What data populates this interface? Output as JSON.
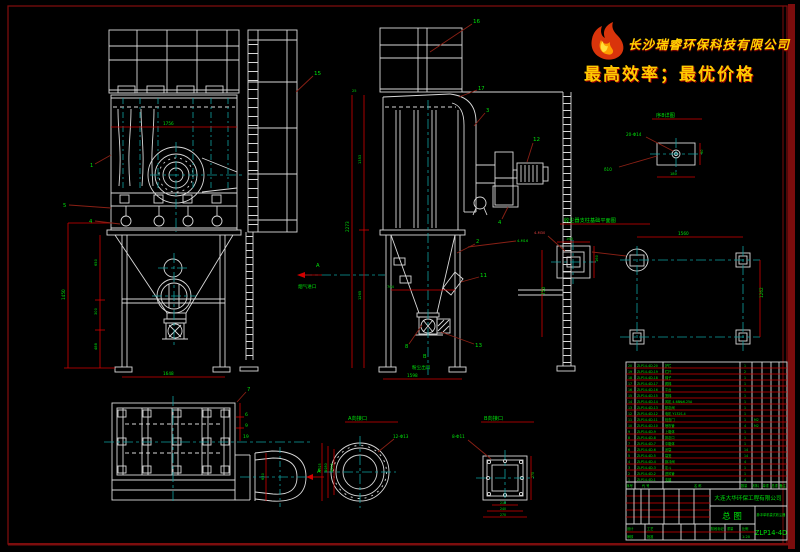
{
  "logo": {
    "company": "长沙瑞睿环保科技有限公司",
    "tagline": "最高效率；最优价格"
  },
  "front": {
    "balloons": {
      "b15": "15",
      "b1": "1",
      "b5": "5",
      "b4": "4"
    },
    "dims": {
      "mid_width": "1756",
      "total_h": "1450",
      "seg1": "650",
      "seg2": "300",
      "seg3": "488",
      "bottom": "1648"
    }
  },
  "side": {
    "balloons": {
      "b16": "16",
      "b17": "17",
      "b3": "3",
      "b12": "12",
      "b4": "4",
      "b2": "2",
      "b11": "11",
      "b13": "13",
      "b8": "8"
    },
    "labels": {
      "arrow_a": "A",
      "inlet": "烟气进口",
      "arrow_b": "B",
      "outlet": "粉尘出口",
      "bolt_note": "4-M16"
    },
    "dims": {
      "total": "2273",
      "upper": "1353",
      "lower": "1265",
      "right": "750",
      "hopper": "704",
      "bottom": "1598",
      "top": "25"
    }
  },
  "plan": {
    "balloons": {
      "b7": "7",
      "b6": "6",
      "b9": "9",
      "b19": "19"
    },
    "labels": {
      "arrow_a": "A"
    },
    "dims": {
      "duct": "630"
    }
  },
  "detail8": {
    "title": "序8详图",
    "holes": "20-Φ14",
    "thickness": "δ10",
    "width": "180",
    "height": "90"
  },
  "foundation": {
    "title": "收尘器支柱基础平面图",
    "dims": {
      "width": "1560",
      "depth": "1262",
      "pad_w": "160",
      "pad_h": "160"
    },
    "anchor_note": "4-M30"
  },
  "flange_a": {
    "title": "A向接口",
    "holes": "12-Φ13",
    "d1": "Φ245",
    "d2": "Φ280",
    "d3": "Φ325"
  },
  "flange_b": {
    "title": "B向接口",
    "holes": "8-Φ11",
    "w1": "210",
    "w2": "240",
    "w3": "270",
    "h": "270"
  },
  "bom": {
    "headers": [
      "序号",
      "代  号",
      "名  称",
      "数量",
      "材料",
      "单重",
      "总重",
      "备注"
    ],
    "rows": [
      {
        "no": "20",
        "code": "ZLP14-4D-20",
        "name": "护栏",
        "qty": "1",
        "mat": ""
      },
      {
        "no": "19",
        "code": "ZLP14-4D-19",
        "name": "栏杆",
        "qty": "2",
        "mat": ""
      },
      {
        "no": "18",
        "code": "ZLP14-4D-18",
        "name": "梯子",
        "qty": "1",
        "mat": ""
      },
      {
        "no": "17",
        "code": "ZLP14-4D-17",
        "name": "爬梯",
        "qty": "1",
        "mat": ""
      },
      {
        "no": "16",
        "code": "ZLP14-4D-16",
        "name": "平台",
        "qty": "1",
        "mat": ""
      },
      {
        "no": "15",
        "code": "ZLP14-4D-15",
        "name": "笼梯",
        "qty": "1",
        "mat": ""
      },
      {
        "no": "14",
        "code": "ZLP14-4D-14",
        "name": "风机 4-68№6.25A",
        "qty": "1",
        "mat": ""
      },
      {
        "no": "13",
        "code": "ZLP14-4D-13",
        "name": "卸灰阀",
        "qty": "1",
        "mat": ""
      },
      {
        "no": "12",
        "code": "ZLP14-4D-12",
        "name": "电机 Y132S-4",
        "qty": "1",
        "mat": ""
      },
      {
        "no": "11",
        "code": "ZLP14-4D-11",
        "name": "检查门",
        "qty": "1",
        "mat": "M2"
      },
      {
        "no": "10",
        "code": "ZLP14-4D-10",
        "name": "喷吹管",
        "qty": "4",
        "mat": "M2"
      },
      {
        "no": "9",
        "code": "ZLP14-4D-9",
        "name": "上箱体",
        "qty": "1",
        "mat": ""
      },
      {
        "no": "8",
        "code": "ZLP14-4D-8",
        "name": "排灰口",
        "qty": "1",
        "mat": ""
      },
      {
        "no": "7",
        "code": "ZLP14-4D-7",
        "name": "中箱体",
        "qty": "1",
        "mat": ""
      },
      {
        "no": "6",
        "code": "ZLP14-4D-6",
        "name": "滤袋",
        "qty": "14",
        "mat": ""
      },
      {
        "no": "5",
        "code": "ZLP14-4D-5",
        "name": "袋笼",
        "qty": "14",
        "mat": ""
      },
      {
        "no": "4",
        "code": "ZLP14-4D-4",
        "name": "脉冲阀",
        "qty": "4",
        "mat": ""
      },
      {
        "no": "3",
        "code": "ZLP14-4D-3",
        "name": "灰斗",
        "qty": "1",
        "mat": ""
      },
      {
        "no": "2",
        "code": "ZLP14-4D-2",
        "name": "进风管",
        "qty": "1",
        "mat": ""
      },
      {
        "no": "1",
        "code": "ZLP14-4D-1",
        "name": "支腿",
        "qty": "4",
        "mat": ""
      }
    ]
  },
  "titleblock": {
    "company": "大连大华环保工程有限公司",
    "drawing_type": "总 图",
    "product_name": "脉冲单机袋式收尘器",
    "drawing_no": "ZLP14-4D",
    "stage_label": "阶段标记",
    "weight_label": "重量",
    "scale_label": "比例",
    "scale": "1:20",
    "sign1": "设计",
    "sign2": "审核",
    "sign3": "工艺",
    "sign4": "批准"
  }
}
